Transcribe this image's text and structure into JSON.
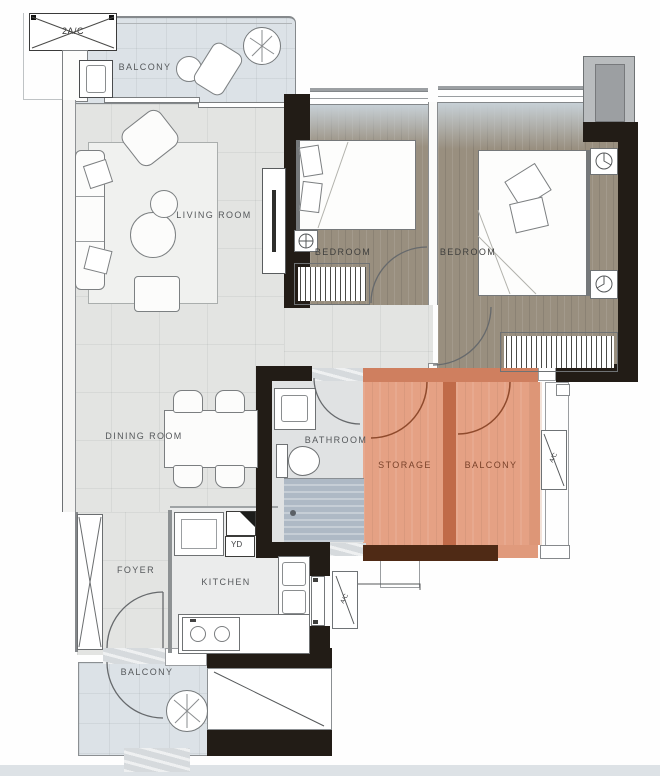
{
  "plan": {
    "unit_label": "2A/C",
    "rooms": {
      "balcony_top": {
        "label": "BALCONY"
      },
      "living": {
        "label": "LIVING ROOM"
      },
      "bedroom_left": {
        "label": "BEDROOM"
      },
      "bedroom_right": {
        "label": "BEDROOM"
      },
      "dining": {
        "label": "DINING ROOM"
      },
      "bathroom": {
        "label": "BATHROOM"
      },
      "storage": {
        "label": "STORAGE"
      },
      "balcony_right": {
        "label": "BALCONY"
      },
      "foyer": {
        "label": "FOYER"
      },
      "kitchen": {
        "label": "KITCHEN"
      },
      "balcony_bottom": {
        "label": "BALCONY"
      }
    },
    "annotations": {
      "yard_box": "YD",
      "ac_right": "A/C",
      "ac_kitchen": "A/C"
    },
    "colors": {
      "highlight_fill": "#e5a184",
      "highlight_wall": "#c06a48",
      "wall_black": "#221c16",
      "wood_floor": "#998f7f",
      "balcony_floor": "#dce2e7",
      "interior_floor": "#e3e4e2",
      "dark_brown_wall": "#4f2a15"
    }
  }
}
